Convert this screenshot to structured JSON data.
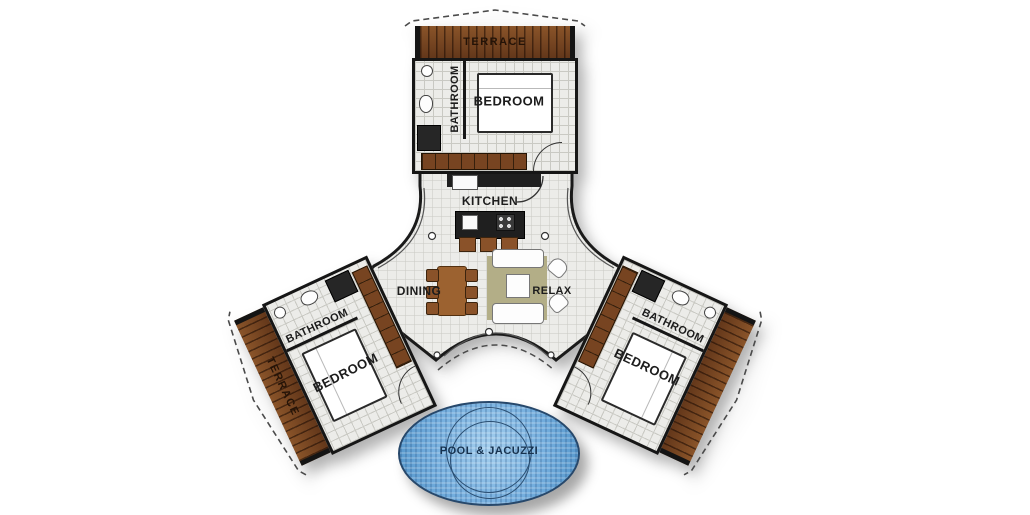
{
  "plan": {
    "wings": {
      "top": {
        "terrace": "TERRACE",
        "bathroom": "BATHROOM",
        "bedroom": "BEDROOM"
      },
      "left": {
        "terrace": "TERRACE",
        "bathroom": "BATHROOM",
        "bedroom": "BEDROOM"
      },
      "right": {
        "bathroom": "BATHROOM",
        "bedroom": "BEDROOM"
      }
    },
    "hub": {
      "kitchen": "KITCHEN",
      "dining": "DINING",
      "relax": "RELAX"
    },
    "pool": {
      "label": "POOL & JACUZZI"
    }
  },
  "colors": {
    "wall": "#161616",
    "floor_tile": "#ecece9",
    "floor_grid": "#c9c9c3",
    "terrace_wood": "#7c4a24",
    "furniture_wood": "#8a5229",
    "rug": "#b3ae87",
    "pool_water": "#74aede",
    "pool_outline": "#27486b",
    "label_text": "#1c1c1c",
    "background": "#ffffff"
  }
}
